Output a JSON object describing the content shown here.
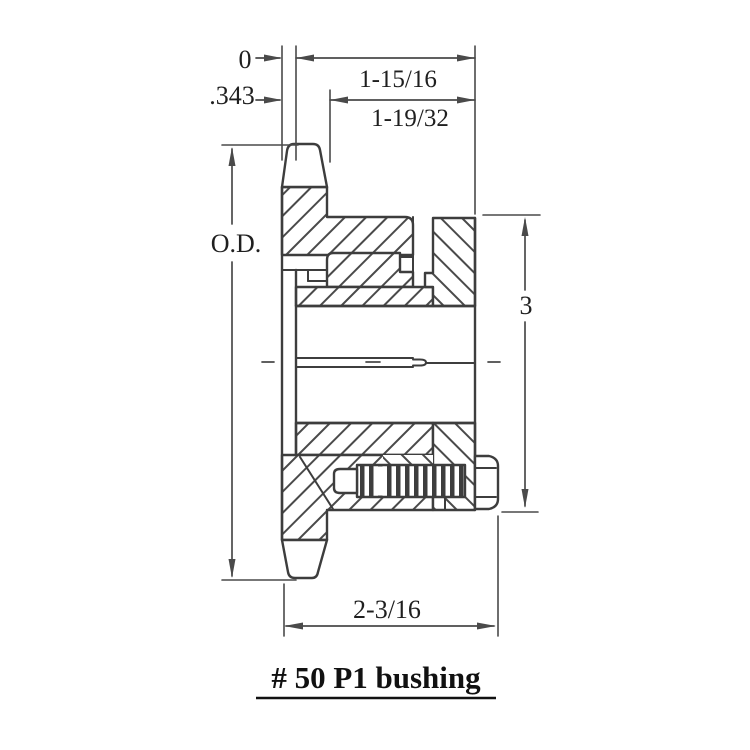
{
  "drawing": {
    "type": "engineering-cross-section",
    "subject": "roller chain sprocket with split taper bushing and cap screw",
    "title": "# 50 P1 bushing",
    "colors": {
      "line": "#3d3d3d",
      "hatch": "#4a4a4a",
      "dimension": "#4a4a4a",
      "text": "#1f1f1f",
      "background": "#ffffff"
    },
    "dimensions": {
      "zero_reference": "0",
      "face_offset": ".343",
      "hub_to_flange_length": "1-15/16",
      "bushing_length": "1-19/32",
      "outside_diameter": "O.D.",
      "flange_diameter": "3",
      "overall_width": "2-3/16"
    }
  }
}
